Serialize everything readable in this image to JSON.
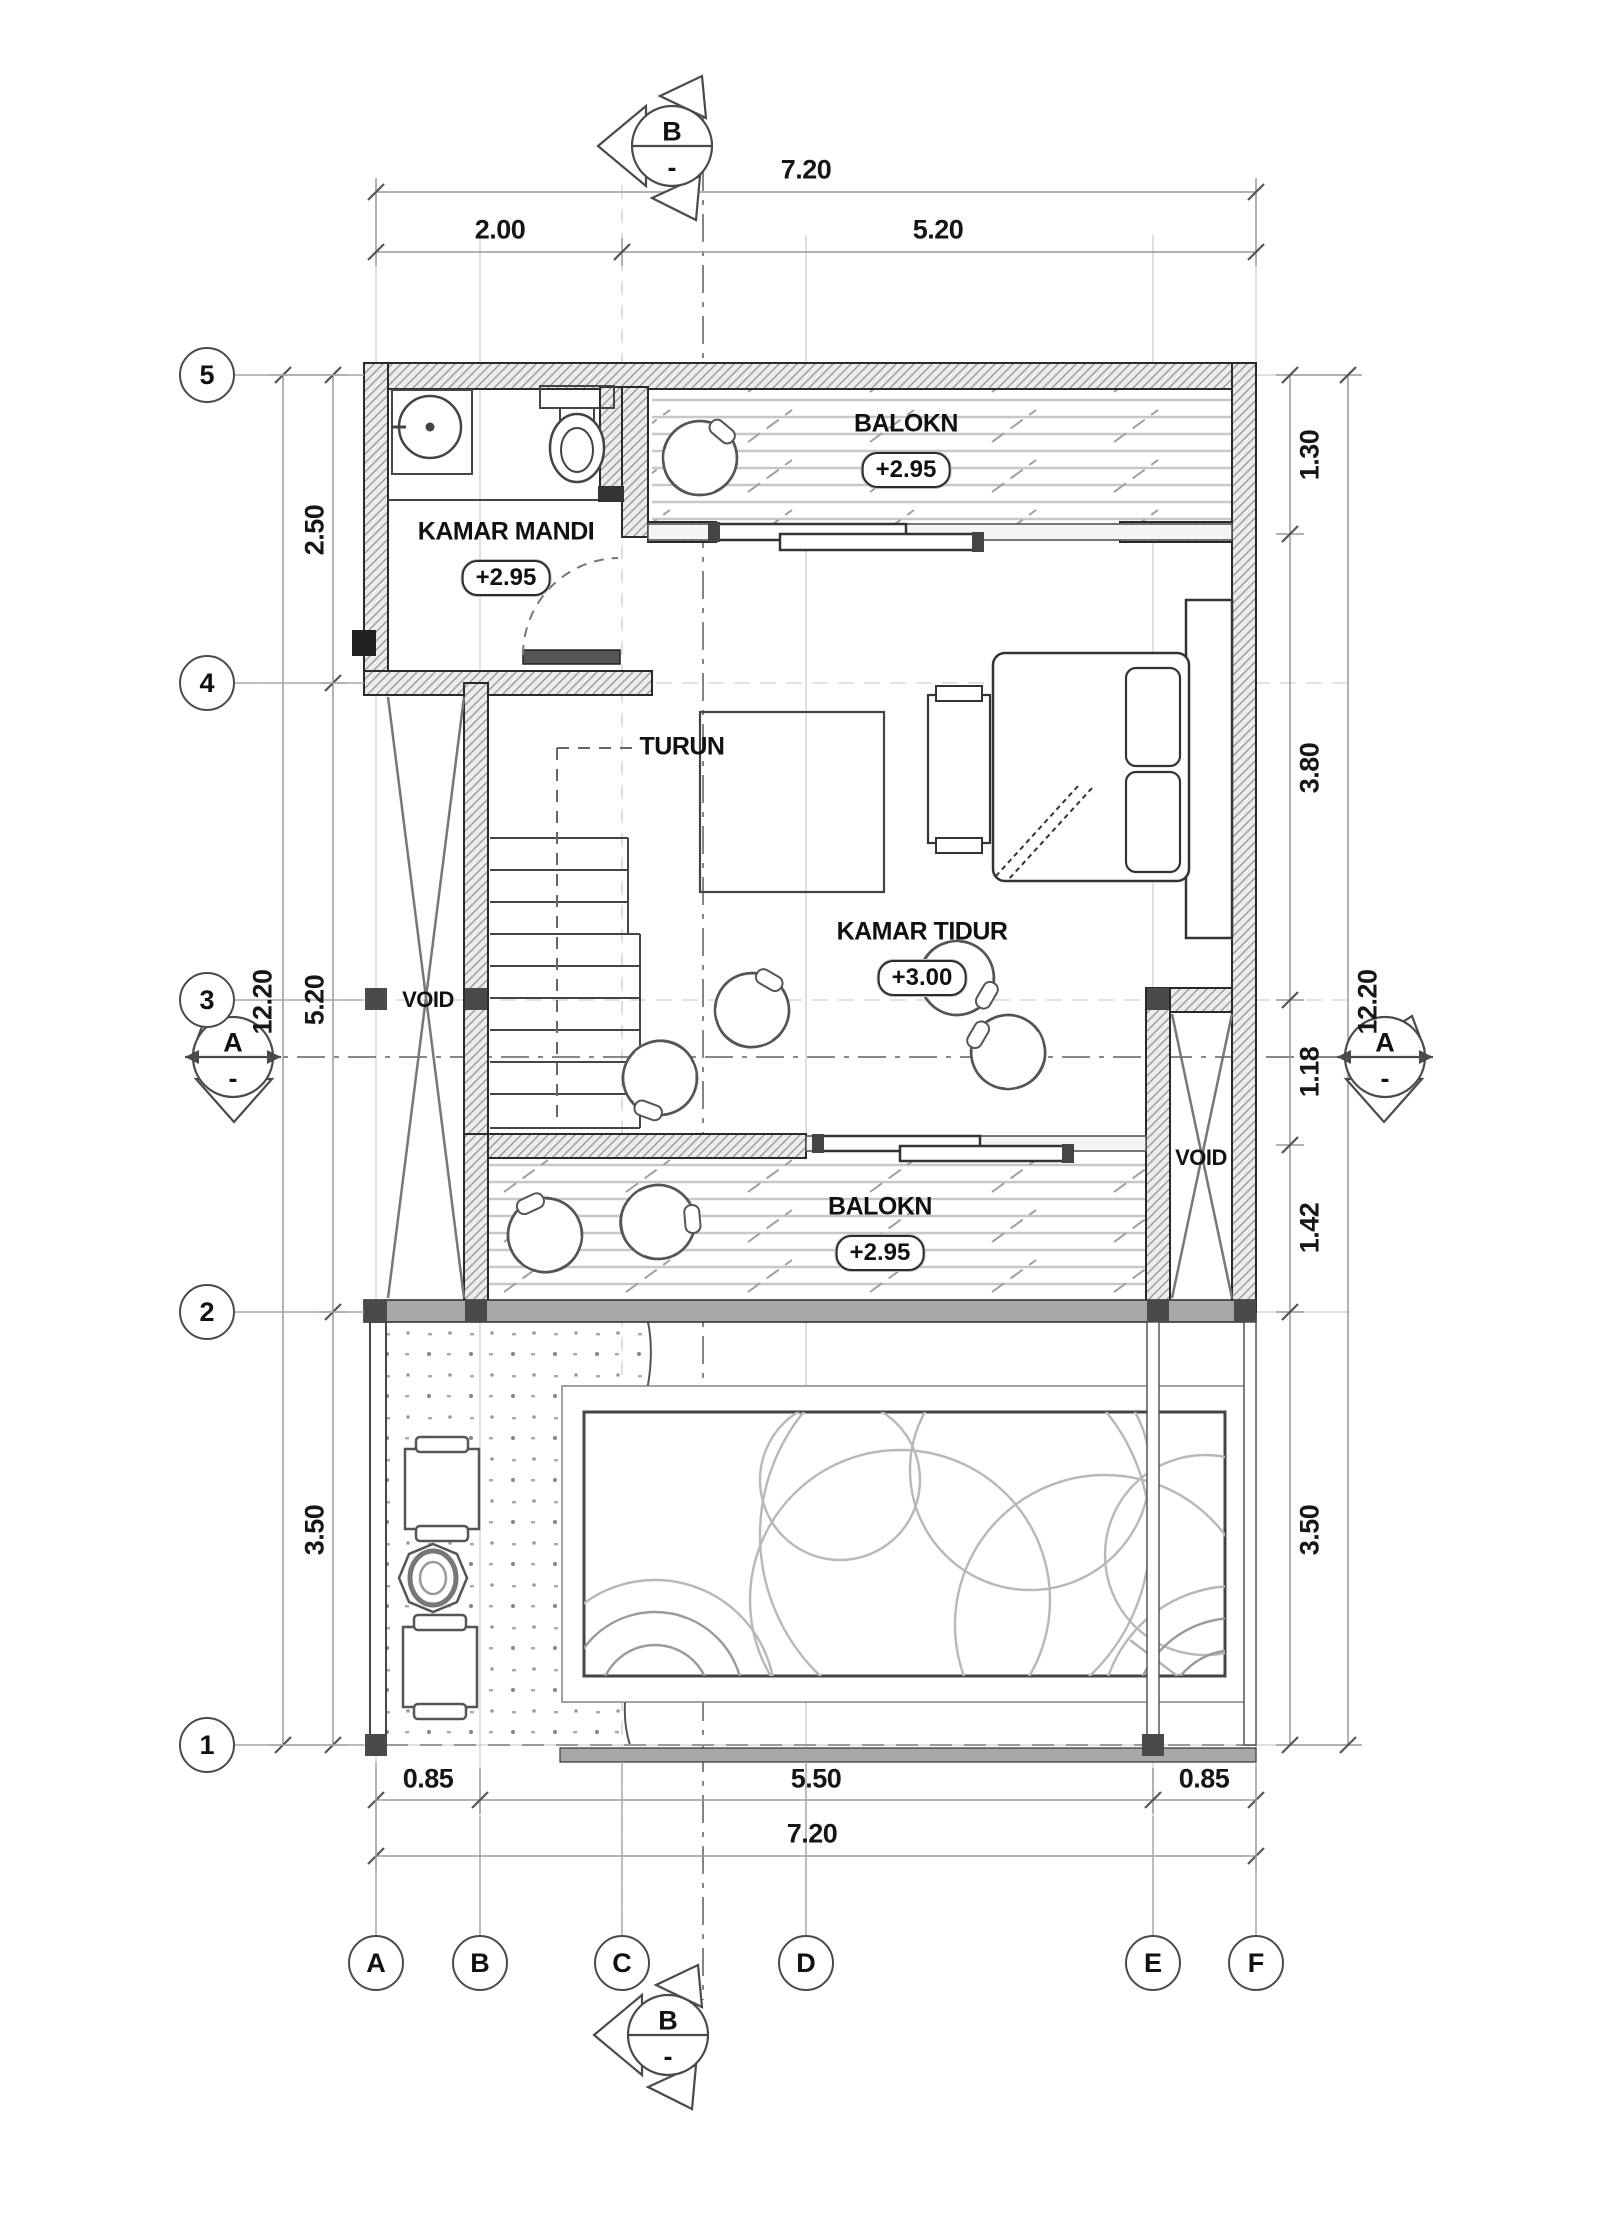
{
  "rooms": {
    "bathroom": {
      "name": "KAMAR MANDI",
      "level": "+2.95"
    },
    "balcony_top": {
      "name": "BALOKN",
      "level": "+2.95"
    },
    "bedroom": {
      "name": "KAMAR TIDUR",
      "level": "+3.00"
    },
    "balcony_mid": {
      "name": "BALOKN",
      "level": "+2.95"
    },
    "void_left": "VOID",
    "void_right": "VOID",
    "stairs_note": "TURUN"
  },
  "grid": {
    "rows": [
      "5",
      "4",
      "3",
      "2",
      "1"
    ],
    "cols": [
      "A",
      "B",
      "C",
      "D",
      "E",
      "F"
    ]
  },
  "sections": {
    "b_top": {
      "letter": "B",
      "sub": "-"
    },
    "b_bottom": {
      "letter": "B",
      "sub": "-"
    },
    "a_left": {
      "letter": "A",
      "sub": "-"
    },
    "a_right": {
      "letter": "A",
      "sub": "-"
    }
  },
  "dims": {
    "top_total": "7.20",
    "top_segments": [
      "2.00",
      "5.20"
    ],
    "bottom_segments": [
      "0.85",
      "5.50",
      "0.85"
    ],
    "bottom_total": "7.20",
    "left_total": "12.20",
    "left_segments": [
      "2.50",
      "5.20",
      "3.50"
    ],
    "right_total": "12.20",
    "right_segments": [
      "1.30",
      "3.80",
      "1.18",
      "1.42",
      "3.50"
    ]
  },
  "colors": {
    "line": "#222222",
    "grid": "#d0d0d0",
    "dim": "#8a8a8a",
    "wall_fill": "#ececec",
    "band": "#a8a8a8",
    "pool_arc": "#b8b8b8"
  }
}
